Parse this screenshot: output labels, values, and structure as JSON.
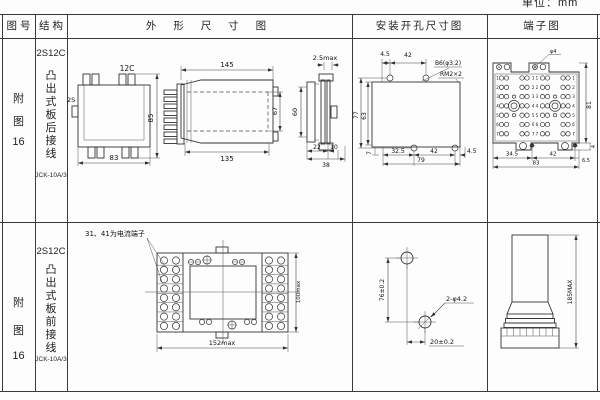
{
  "unit_label": "单位：mm",
  "header": {
    "fig_no": "图 号",
    "structure": "结 构",
    "outline": "外 形 尺 寸 图",
    "install": "安装开孔尺寸图",
    "terminal": "端子图"
  },
  "row1": {
    "fig": [
      "附",
      "图",
      "16"
    ],
    "structure": {
      "type": "2S12C",
      "desc": "凸出式板后接线",
      "model": "JCK-10A/3"
    },
    "outline": {
      "front_top": "12C",
      "front_side": "2S",
      "front_h": "85",
      "front_w": "83",
      "side_top": "145",
      "side_bottom": "135",
      "side_h": "67",
      "end_top": "2.5max",
      "end_h": "60",
      "end_d1": "22",
      "end_d2": "10",
      "end_d3": "38"
    },
    "install": {
      "top1": "4.5",
      "top2": "42",
      "hole": "B6(φ3.2)",
      "thread": "RM2×2",
      "left1": "77",
      "left2": "63",
      "bot0": "7",
      "bot1": "32.5",
      "bot2": "42",
      "bot3": "4.5",
      "total": "79"
    },
    "terminal": {
      "pin_label": "φ4",
      "height": "81",
      "tab": "4",
      "bot1": "34.5",
      "bot2": "42",
      "bot3": "6.5",
      "total": "83",
      "rows": [
        "1",
        "2",
        "3",
        "4",
        "5",
        "6",
        "7"
      ]
    }
  },
  "row2": {
    "fig": [
      "附",
      "图",
      "16"
    ],
    "structure": {
      "type": "2S12C",
      "desc": "凸出式板前接线",
      "model": "JCK-10A/3"
    },
    "outline": {
      "note": "31、41为电流端子",
      "width": "152max",
      "height": "100max"
    },
    "install": {
      "v": "76±0.2",
      "h": "20±0.2",
      "hole": "2-φ4.2"
    },
    "terminal": {
      "height": "185MAX"
    }
  }
}
